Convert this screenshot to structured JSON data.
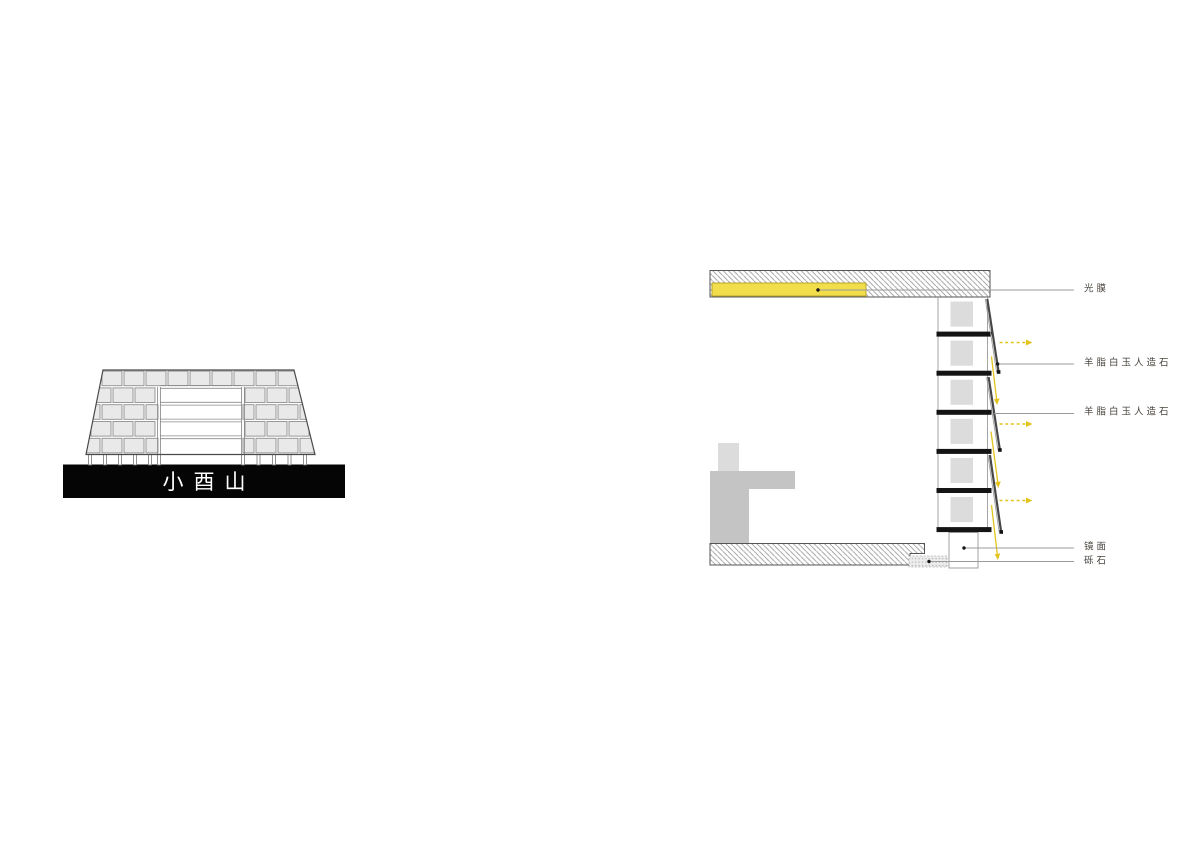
{
  "figure": {
    "elevation": {
      "caption": "小酉山"
    },
    "section": {
      "labels": [
        {
          "id": "light-film",
          "text": "光膜"
        },
        {
          "id": "artificial-jade-stone-upper",
          "text": "羊脂白玉人造石"
        },
        {
          "id": "artificial-jade-stone-lower",
          "text": "羊脂白玉人造石"
        },
        {
          "id": "mirror",
          "text": "镜面"
        },
        {
          "id": "gravel",
          "text": "砾石"
        }
      ]
    }
  },
  "colors": {
    "background": "#ffffff",
    "accent_yellow": "#f2de4a",
    "accent_yellow_border": "#b9a72b",
    "arrow_yellow": "#e3c41e",
    "base_black": "#050505",
    "caption_white": "#ffffff",
    "label_text": "#4a443e",
    "leader_gray": "#9b9b9b",
    "hatch_gray": "#9a9a9a",
    "slab_outline": "#555555",
    "block_fill": "#e9e9e9",
    "block_stroke": "#8f8f8f",
    "bar_black": "#141414",
    "unit_square_gray": "#dcdcdc",
    "panel_dark": "#474747",
    "figure_gray": "#c4c4c4",
    "figure_light_gray": "#dcdcdc"
  }
}
